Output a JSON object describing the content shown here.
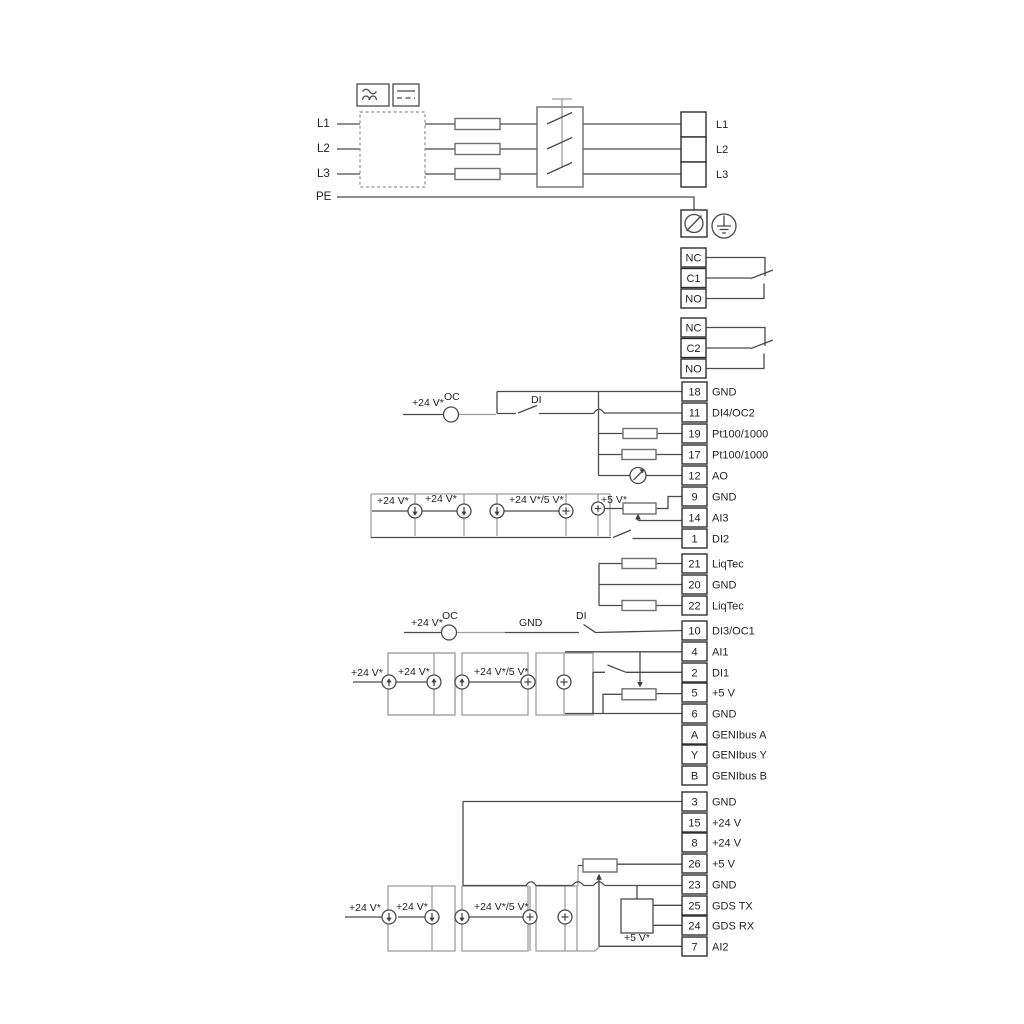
{
  "power": {
    "in_labels": [
      "L1",
      "L2",
      "L3",
      "PE"
    ],
    "out_labels": [
      "L1",
      "L2",
      "L3"
    ]
  },
  "relays": {
    "r1": [
      "NC",
      "C1",
      "NO"
    ],
    "r2": [
      "NC",
      "C2",
      "NO"
    ]
  },
  "groups": {
    "g1": [
      {
        "pin": "18",
        "label": "GND"
      },
      {
        "pin": "11",
        "label": "DI4/OC2"
      },
      {
        "pin": "19",
        "label": "Pt100/1000"
      },
      {
        "pin": "17",
        "label": "Pt100/1000"
      },
      {
        "pin": "12",
        "label": "AO"
      },
      {
        "pin": "9",
        "label": "GND"
      },
      {
        "pin": "14",
        "label": "AI3"
      },
      {
        "pin": "1",
        "label": "DI2"
      }
    ],
    "liqtec": [
      {
        "pin": "21",
        "label": "LiqTec"
      },
      {
        "pin": "20",
        "label": "GND"
      },
      {
        "pin": "22",
        "label": "LiqTec"
      }
    ],
    "g3": [
      {
        "pin": "10",
        "label": "DI3/OC1"
      },
      {
        "pin": "4",
        "label": "AI1"
      },
      {
        "pin": "2",
        "label": "DI1"
      },
      {
        "pin": "5",
        "label": "+5 V"
      },
      {
        "pin": "6",
        "label": "GND"
      },
      {
        "pin": "A",
        "label": "GENIbus A"
      },
      {
        "pin": "Y",
        "label": "GENIbus Y"
      },
      {
        "pin": "B",
        "label": "GENIbus B"
      }
    ],
    "g4": [
      {
        "pin": "3",
        "label": "GND"
      },
      {
        "pin": "15",
        "label": "+24 V"
      },
      {
        "pin": "8",
        "label": "+24 V"
      },
      {
        "pin": "26",
        "label": "+5 V"
      },
      {
        "pin": "23",
        "label": "GND"
      },
      {
        "pin": "25",
        "label": "GDS TX"
      },
      {
        "pin": "24",
        "label": "GDS RX"
      },
      {
        "pin": "7",
        "label": "AI2"
      }
    ]
  },
  "ann": {
    "di4_supply": "+24 V*",
    "di4_oc": "OC",
    "di4_di": "DI",
    "row1": [
      "+24 V*",
      "+24 V*",
      "+24 V*/5 V*",
      "+5 V*"
    ],
    "di3_supply": "+24 V*",
    "di3_oc": "OC",
    "di3_gnd": "GND",
    "di3_di": "DI",
    "row2": [
      "+24 V*",
      "+24 V*",
      "+24 V*/5 V*"
    ],
    "row3": [
      "+24 V*",
      "+24 V*",
      "+24 V*/5 V*"
    ],
    "gds_supply": "+5 V*"
  }
}
